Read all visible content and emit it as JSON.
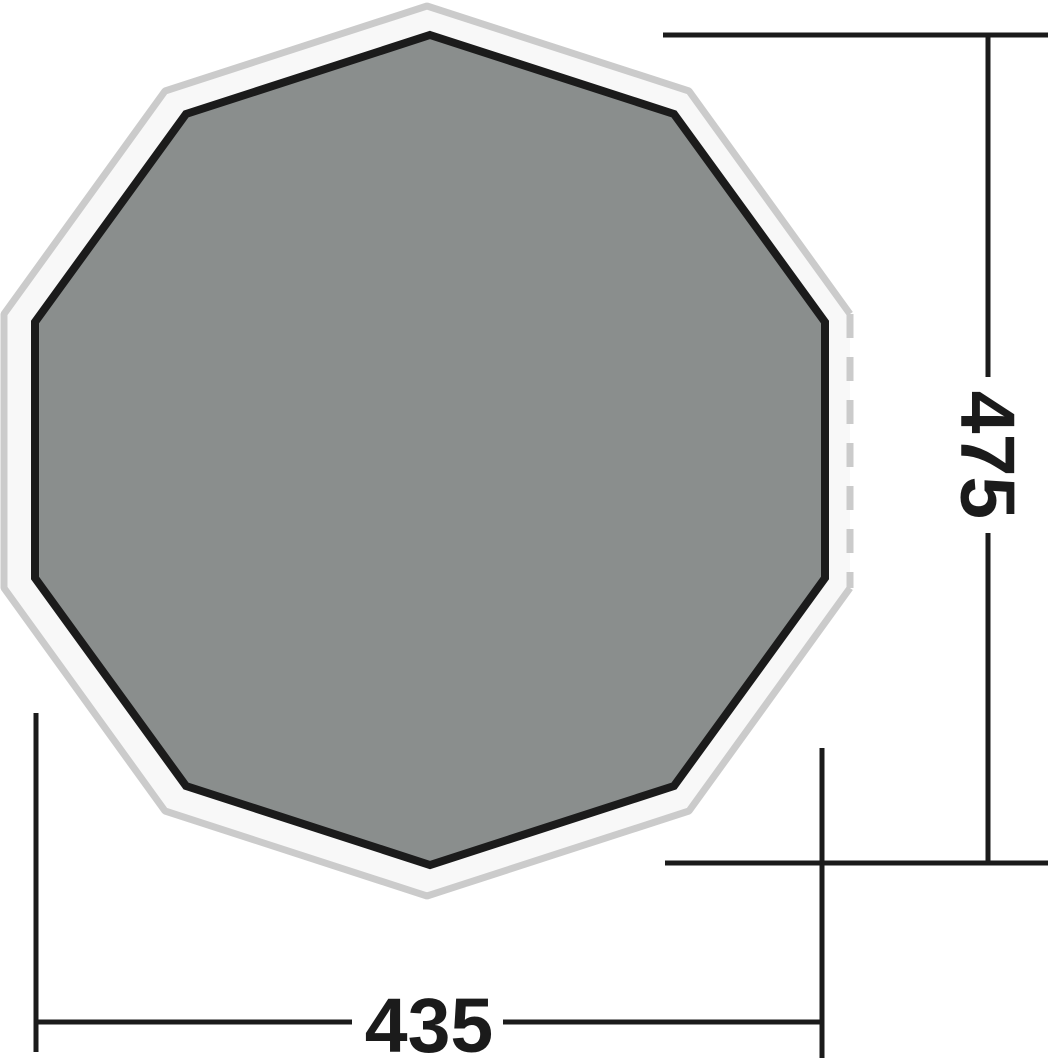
{
  "diagram": {
    "shape": "decagon",
    "sides": 10,
    "dimensions": {
      "height_label": "475",
      "width_label": "435"
    },
    "colors": {
      "groundsheet_fill": "#8a8e8d",
      "groundsheet_outline": "#1b1b1b",
      "flysheet_fill": "#f8f8f8",
      "flysheet_outline": "#cbcbcb",
      "dimension_line": "#1b1b1b",
      "page_background": "#ffffff"
    },
    "style": {
      "dashed_edge_pattern": "24 19"
    }
  }
}
